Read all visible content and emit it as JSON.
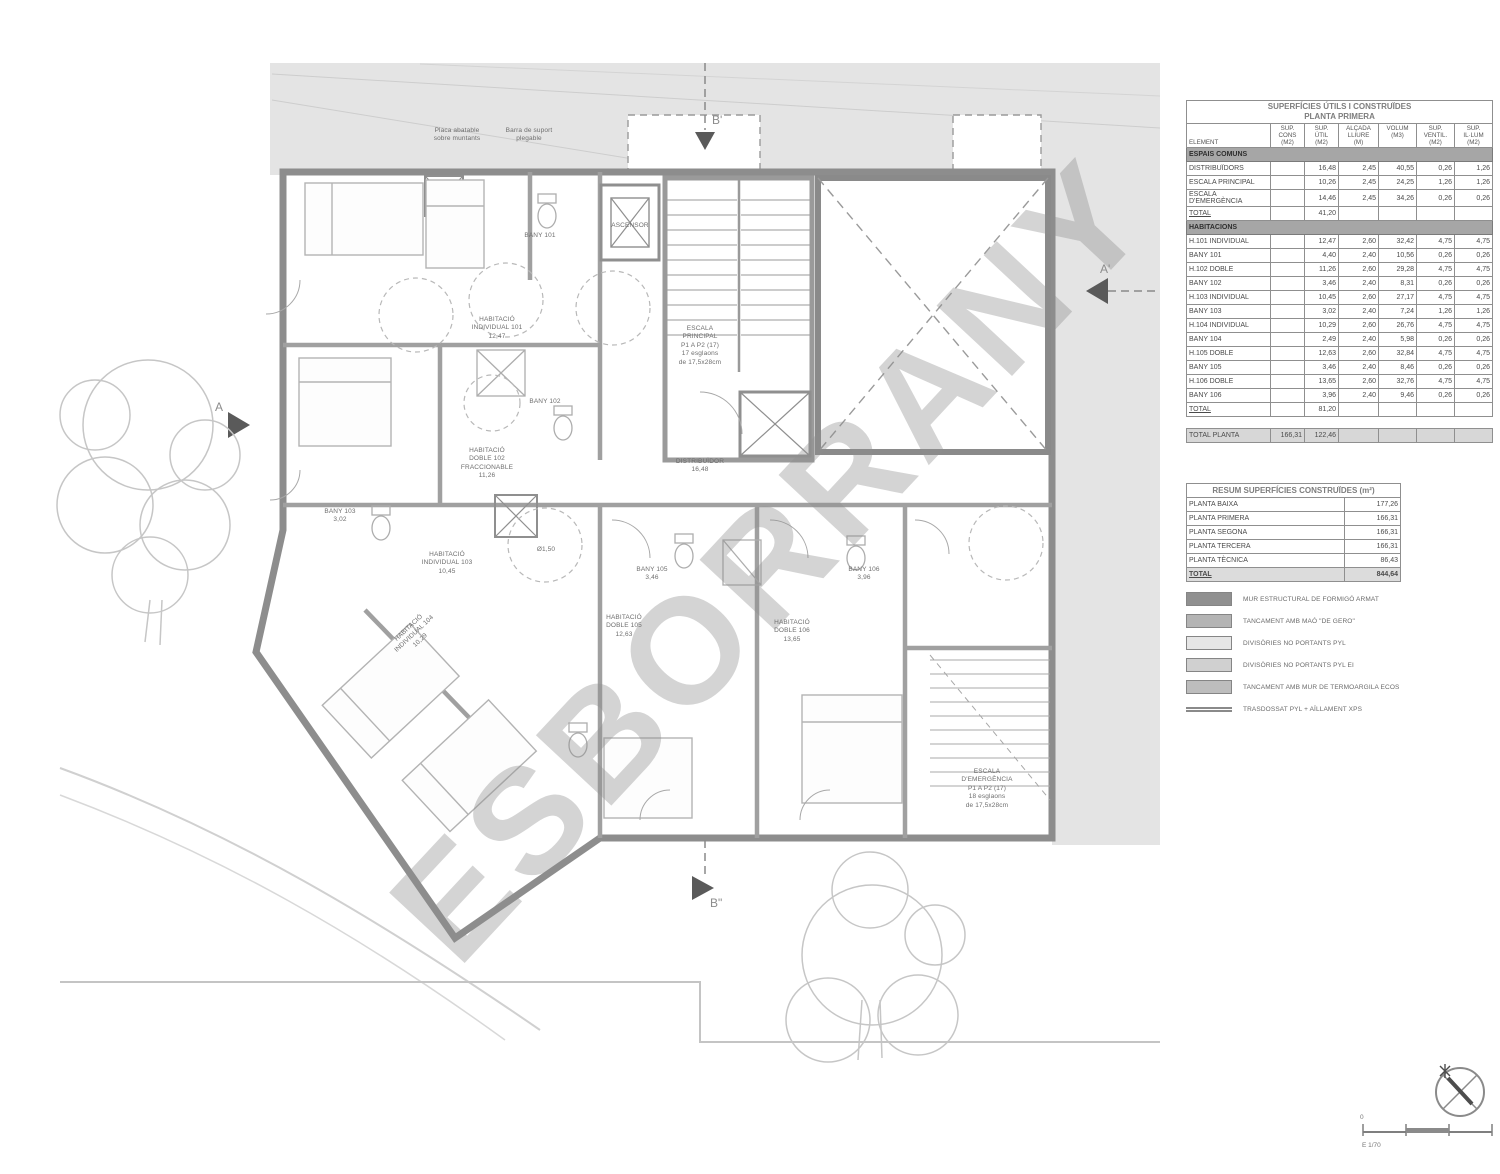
{
  "watermark": "ESBORRANY",
  "markers": {
    "a": "A",
    "a_prime": "A'",
    "b_prime": "B'",
    "b_double": "B\""
  },
  "scale": {
    "zero": "0",
    "label": "E 1/70"
  },
  "plan": {
    "labels": {
      "note1": "Placa abatable\nsobre muntants",
      "note2": "Barra de suport\nplegable",
      "h101": "HABITACIÓ\nINDIVIDUAL 101\n12,47",
      "bany101": "BANY 101",
      "escala_principal": "ESCALA\nPRINCIPAL\nP1 A P2 (17)\n17 esglaons\nde 17,5x28cm",
      "ascensor": "ASCENSOR",
      "h102": "HABITACIÓ\nDOBLE 102\nFRACCIONABLE\n11,26",
      "bany102": "BANY 102",
      "distribuidor": "DISTRIBUÏDOR\n16,48",
      "bany103": "BANY 103\n3,02",
      "h103": "HABITACIÓ\nINDIVIDUAL 103\n10,45",
      "h104": "HABITACIÓ\nINDIVIDUAL 104\n10,29",
      "h105": "HABITACIÓ\nDOBLE 105\n12,63",
      "bany105": "BANY 105\n3,46",
      "h106": "HABITACIÓ\nDOBLE 106\n13,65",
      "bany106": "BANY 106\n3,96",
      "escala_emergencia": "ESCALA\nD'EMERGÈNCIA\nP1 A P2 (17)\n18 esglaons\nde 17,5x28cm",
      "diameter": "Ø1,50"
    }
  },
  "tables": {
    "main": {
      "title": "SUPERFÍCIES ÚTILS I CONSTRUÏDES\nPLANTA PRIMERA",
      "columns": [
        "ELEMENT",
        "SUP.\nCONS\n(M2)",
        "SUP.\nÚTIL\n(M2)",
        "ALÇADA\nLLIURE\n(M)",
        "VOLUM\n(M3)",
        "SUP.\nVENTIL.\n(M2)",
        "SUP.\nIL·LUM\n(M2)"
      ],
      "rows": [
        {
          "type": "section",
          "label": "ESPAIS COMUNS",
          "cells": [
            "",
            "",
            "",
            "",
            "",
            ""
          ]
        },
        {
          "type": "data",
          "label": "DISTRIBUÏDORS",
          "cells": [
            "",
            "16,48",
            "2,45",
            "40,55",
            "0,26",
            "1,26"
          ]
        },
        {
          "type": "data",
          "label": "ESCALA PRINCIPAL",
          "cells": [
            "",
            "10,26",
            "2,45",
            "24,25",
            "1,26",
            "1,26"
          ]
        },
        {
          "type": "data",
          "label": "ESCALA D'EMERGÈNCIA",
          "cells": [
            "",
            "14,46",
            "2,45",
            "34,26",
            "0,26",
            "0,26"
          ]
        },
        {
          "type": "total",
          "label": "TOTAL",
          "cells": [
            "",
            "41,20",
            "",
            "",
            "",
            ""
          ]
        },
        {
          "type": "section",
          "label": "HABITACIONS",
          "cells": [
            "",
            "",
            "",
            "",
            "",
            ""
          ]
        },
        {
          "type": "data",
          "label": "H.101 INDIVIDUAL",
          "cells": [
            "",
            "12,47",
            "2,60",
            "32,42",
            "4,75",
            "4,75"
          ]
        },
        {
          "type": "data",
          "label": "BANY 101",
          "cells": [
            "",
            "4,40",
            "2,40",
            "10,56",
            "0,26",
            "0,26"
          ]
        },
        {
          "type": "data",
          "label": "H.102 DOBLE",
          "cells": [
            "",
            "11,26",
            "2,60",
            "29,28",
            "4,75",
            "4,75"
          ]
        },
        {
          "type": "data",
          "label": "BANY 102",
          "cells": [
            "",
            "3,46",
            "2,40",
            "8,31",
            "0,26",
            "0,26"
          ]
        },
        {
          "type": "data",
          "label": "H.103 INDIVIDUAL",
          "cells": [
            "",
            "10,45",
            "2,60",
            "27,17",
            "4,75",
            "4,75"
          ]
        },
        {
          "type": "data",
          "label": "BANY 103",
          "cells": [
            "",
            "3,02",
            "2,40",
            "7,24",
            "1,26",
            "1,26"
          ]
        },
        {
          "type": "data",
          "label": "H.104 INDIVIDUAL",
          "cells": [
            "",
            "10,29",
            "2,60",
            "26,76",
            "4,75",
            "4,75"
          ]
        },
        {
          "type": "data",
          "label": "BANY 104",
          "cells": [
            "",
            "2,49",
            "2,40",
            "5,98",
            "0,26",
            "0,26"
          ]
        },
        {
          "type": "data",
          "label": "H.105 DOBLE",
          "cells": [
            "",
            "12,63",
            "2,60",
            "32,84",
            "4,75",
            "4,75"
          ]
        },
        {
          "type": "data",
          "label": "BANY 105",
          "cells": [
            "",
            "3,46",
            "2,40",
            "8,46",
            "0,26",
            "0,26"
          ]
        },
        {
          "type": "data",
          "label": "H.106 DOBLE",
          "cells": [
            "",
            "13,65",
            "2,60",
            "32,76",
            "4,75",
            "4,75"
          ]
        },
        {
          "type": "data",
          "label": "BANY 106",
          "cells": [
            "",
            "3,96",
            "2,40",
            "9,46",
            "0,26",
            "0,26"
          ]
        },
        {
          "type": "total",
          "label": "TOTAL",
          "cells": [
            "",
            "81,20",
            "",
            "",
            "",
            ""
          ]
        },
        {
          "type": "spacer",
          "label": "",
          "cells": [
            "",
            "",
            "",
            "",
            "",
            ""
          ]
        },
        {
          "type": "grandtotal",
          "label": "TOTAL PLANTA",
          "cells": [
            "166,31",
            "122,46",
            "",
            "",
            "",
            ""
          ]
        }
      ]
    },
    "summary": {
      "title": "RESUM SUPERFÍCIES CONSTRUÏDES (m²)",
      "rows": [
        {
          "type": "data",
          "label": "PLANTA BAIXA",
          "cells": [
            "177,26"
          ]
        },
        {
          "type": "data",
          "label": "PLANTA PRIMERA",
          "cells": [
            "166,31"
          ]
        },
        {
          "type": "data",
          "label": "PLANTA SEGONA",
          "cells": [
            "166,31"
          ]
        },
        {
          "type": "data",
          "label": "PLANTA TERCERA",
          "cells": [
            "166,31"
          ]
        },
        {
          "type": "data",
          "label": "PLANTA TÈCNICA",
          "cells": [
            "86,43"
          ]
        },
        {
          "type": "total",
          "label": "TOTAL",
          "cells": [
            "844,64"
          ]
        }
      ]
    }
  },
  "legend": {
    "items": [
      {
        "label": "MUR ESTRUCTURAL DE FORMIGÓ ARMAT",
        "color": "#909090",
        "style": "box"
      },
      {
        "label": "TANCAMENT AMB MAÓ \"DE GERO\"",
        "color": "#b4b4b4",
        "style": "box"
      },
      {
        "label": "DIVISÒRIES NO PORTANTS PYL",
        "color": "#e6e6e6",
        "style": "box"
      },
      {
        "label": "DIVISÒRIES NO PORTANTS PYL EI",
        "color": "#d0d0d0",
        "style": "box"
      },
      {
        "label": "TANCAMENT AMB MUR DE TERMOARGILA ECOS",
        "color": "#bdbdbd",
        "style": "box"
      },
      {
        "label": "TRASDOSSAT PYL + AÏLLAMENT XPS",
        "color": "#8a8a8a",
        "style": "lines"
      }
    ]
  }
}
